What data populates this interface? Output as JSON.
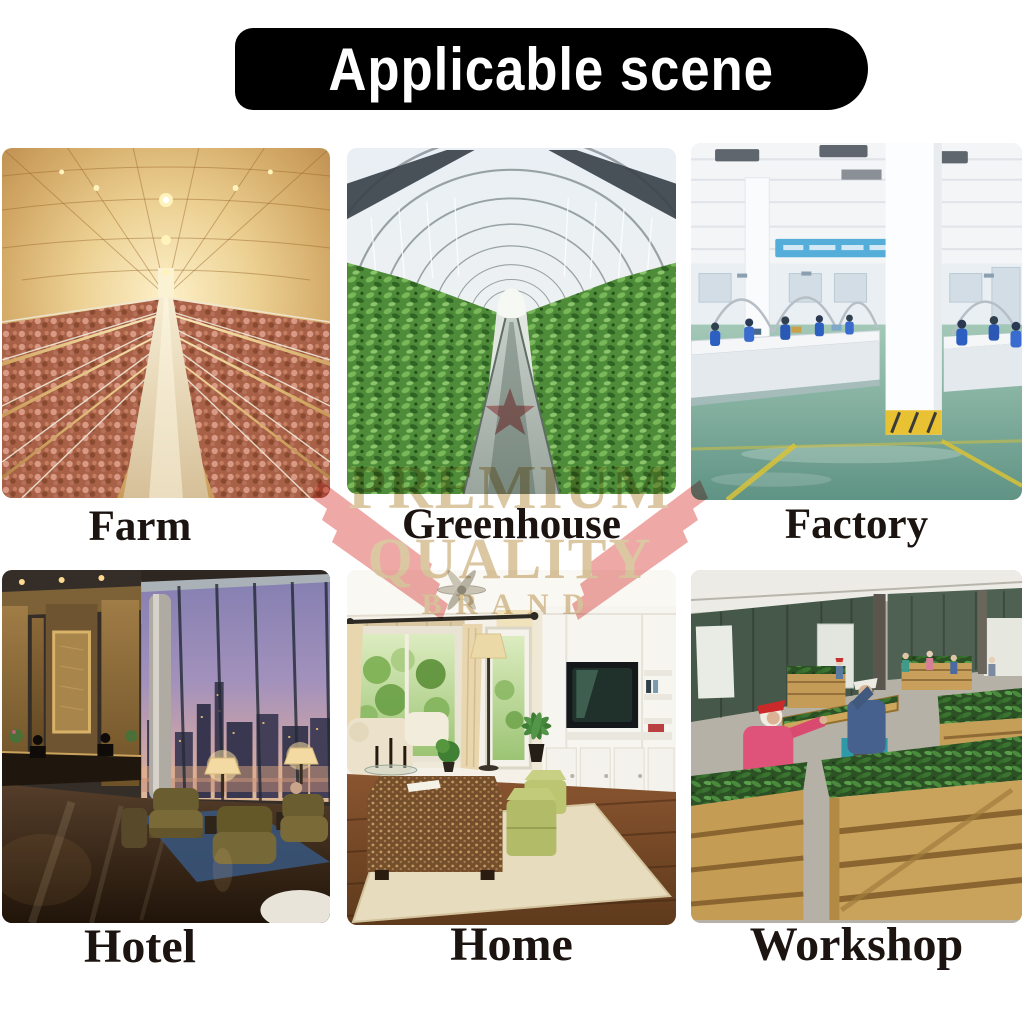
{
  "banner": {
    "title": "Applicable scene",
    "bg_color": "#000000",
    "text_color": "#ffffff"
  },
  "scenes": [
    {
      "label": "Farm"
    },
    {
      "label": "Greenhouse"
    },
    {
      "label": "Factory"
    },
    {
      "label": "Hotel"
    },
    {
      "label": "Home"
    },
    {
      "label": "Workshop"
    }
  ],
  "watermark": {
    "premium": "PREMIUM",
    "quality": "QUALITY",
    "brand": "BRAND"
  },
  "colors": {
    "label_text": "#1c1410",
    "watermark_pink": "#eda2a0",
    "watermark_star": "#db8a8c",
    "watermark_text": "#d8c29a"
  }
}
